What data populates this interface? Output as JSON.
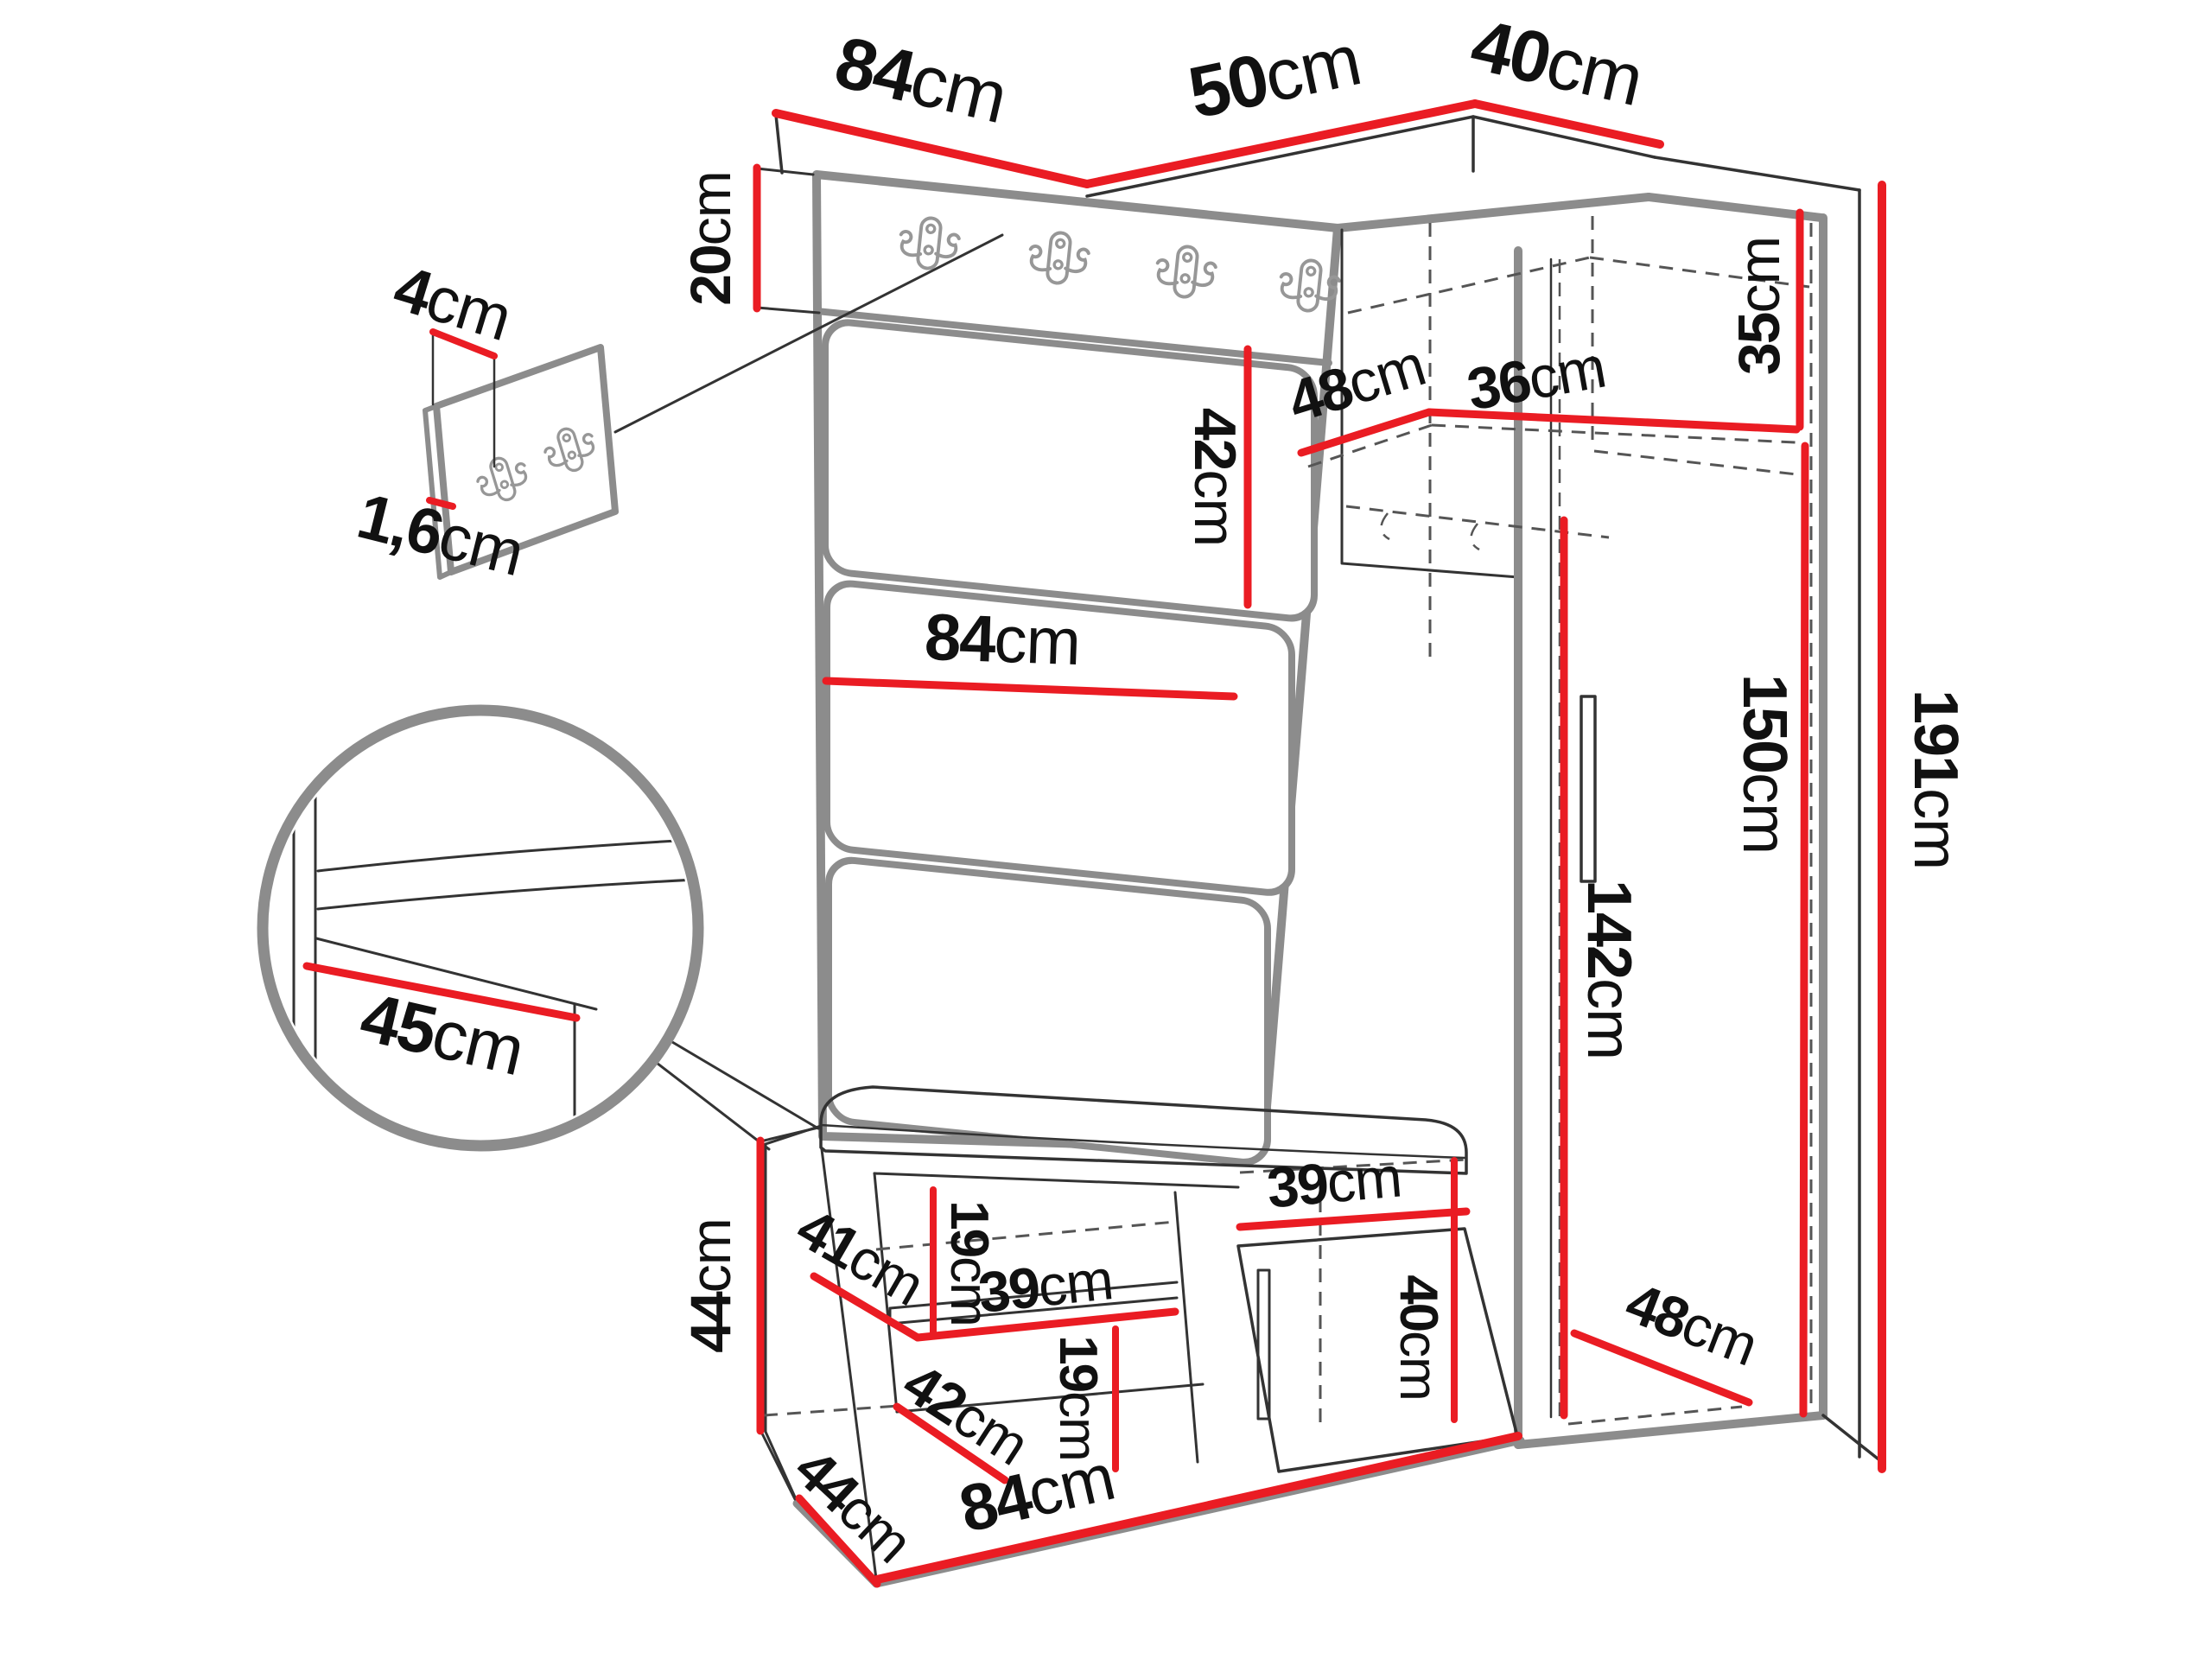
{
  "diagram": {
    "type": "furniture-dimension-diagram",
    "unit": "cm",
    "colors": {
      "dimension_line": "#ea1c23",
      "furniture_outline": "#8c8c8c",
      "detail_line": "#333333",
      "label_text": "#111111",
      "background": "#ffffff"
    },
    "labels": {
      "panel_width_top": {
        "num": "84",
        "unit": "cm"
      },
      "corner_front_width": {
        "num": "50",
        "unit": "cm"
      },
      "corner_side_width": {
        "num": "40",
        "unit": "cm"
      },
      "hook_strip_height": {
        "num": "20",
        "unit": "cm"
      },
      "detail_panel_height": {
        "num": "4",
        "unit": "cm"
      },
      "detail_panel_thickness": {
        "num": "1,6",
        "unit": "cm"
      },
      "cushion_height": {
        "num": "42",
        "unit": "cm"
      },
      "corner_interior_depth": {
        "num": "48",
        "unit": "cm"
      },
      "corner_interior_width": {
        "num": "36",
        "unit": "cm"
      },
      "corner_interior_height": {
        "num": "35",
        "unit": "cm"
      },
      "panel_width_mid": {
        "num": "84",
        "unit": "cm"
      },
      "total_height": {
        "num": "191",
        "unit": "cm"
      },
      "wardrobe_interior_height": {
        "num": "150",
        "unit": "cm"
      },
      "wardrobe_rail_height": {
        "num": "142",
        "unit": "cm"
      },
      "seat_depth_detail": {
        "num": "45",
        "unit": "cm"
      },
      "bench_height": {
        "num": "44",
        "unit": "cm"
      },
      "bench_shelf_depth": {
        "num": "41",
        "unit": "cm"
      },
      "bench_upper_opening_height": {
        "num": "19",
        "unit": "cm"
      },
      "bench_shelf_width": {
        "num": "39",
        "unit": "cm"
      },
      "bench_lower_depth": {
        "num": "42",
        "unit": "cm"
      },
      "bench_lower_opening_height": {
        "num": "19",
        "unit": "cm"
      },
      "bench_door_width": {
        "num": "39",
        "unit": "cm"
      },
      "bench_door_height": {
        "num": "40",
        "unit": "cm"
      },
      "bench_side_depth": {
        "num": "44",
        "unit": "cm"
      },
      "bench_width_bottom": {
        "num": "84",
        "unit": "cm"
      },
      "wardrobe_interior_depth": {
        "num": "48",
        "unit": "cm"
      }
    }
  }
}
